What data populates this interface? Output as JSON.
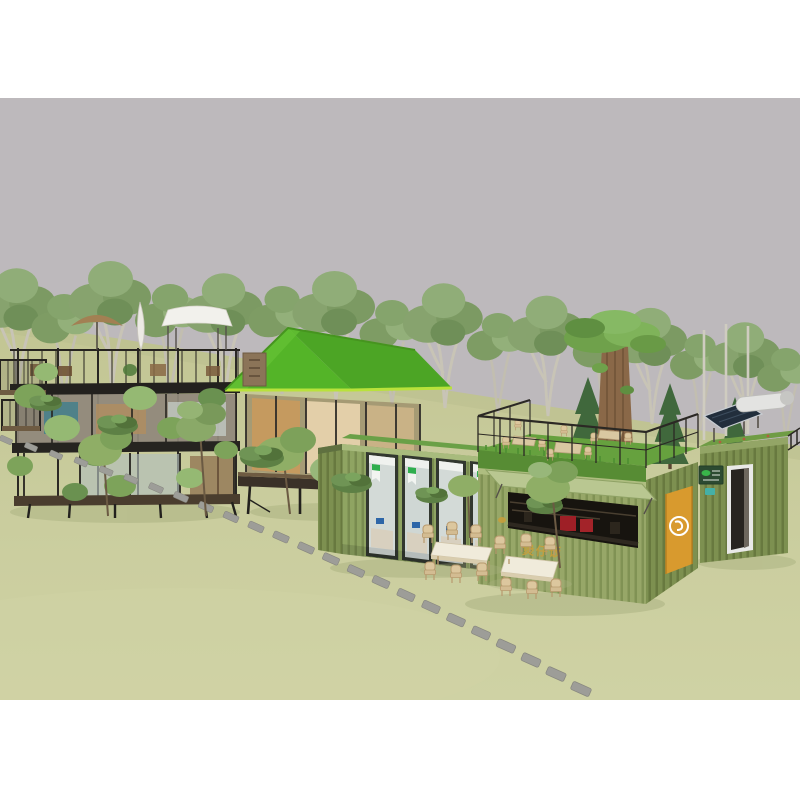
{
  "page": {
    "background": "#ffffff"
  },
  "photo": {
    "kind": "3D architectural rendering",
    "subject": "Eco shipping-container cafe campus on a lawn: steel-frame pavilion with roof-deck umbrellas, grass-roofed stilt cabin, glass-front office container, double-height cafe container with rooftop grass terrace and living tree, utility container with solar water heater, outdoor dining sets and a stepping-stone path",
    "sky_color": "#bdb9bc",
    "ground_color": "#c9cc9d",
    "frame_color": "#ffffff"
  },
  "scene": {
    "tree_line": {
      "count": 16,
      "canopy_color": "#84a06b",
      "trunk_color": "#c8c4b6"
    },
    "conifers": {
      "count": 3,
      "color": "#40683c"
    },
    "left_pavilion": {
      "label": "two-story black steel-frame pavilion with rooftop deck",
      "frame_color": "#2b2824",
      "umbrella_colors": [
        "#a28053",
        "#eceae4",
        "#f2f1ec"
      ]
    },
    "cabin": {
      "label": "grass-roofed cabin on stilts",
      "roof_color": "#54b428",
      "trim_color": "#b9e23b",
      "sign_board_color": "#8b7458"
    },
    "office_container": {
      "label": "glass-front office container",
      "body_color": "#8fa462",
      "window_bays": 4,
      "roof_grass_color": "#6aa047"
    },
    "cafe_container": {
      "label": "cafe container with fold-up serving hatch and rooftop terrace",
      "body_color": "#97a768",
      "sign_text": "煲仔饭",
      "sign_text_color": "#c79f3c",
      "door_color": "#d89a2e",
      "door_logo": "white ring cup emblem",
      "terrace": {
        "grass_color": "#66a13e",
        "tables": 3,
        "railing_color": "#2b2824",
        "tree": "living tree trunk through deck"
      }
    },
    "utility_container": {
      "label": "utility container with solar water heater and open door",
      "body_color": "#7d9050",
      "solar_panel_color": "#222e3c",
      "tank_color": "#e3e3e1",
      "brand_sign_color": "#2c4a31",
      "chip_color": "#45b0a6"
    },
    "outdoor_seating": {
      "dining_sets": 2,
      "table_top_color": "#f0ebdb",
      "chair_color": "#dcc79e"
    },
    "stepping_stone_path": {
      "stones": 24,
      "stone_color": "#9d9d98"
    }
  }
}
